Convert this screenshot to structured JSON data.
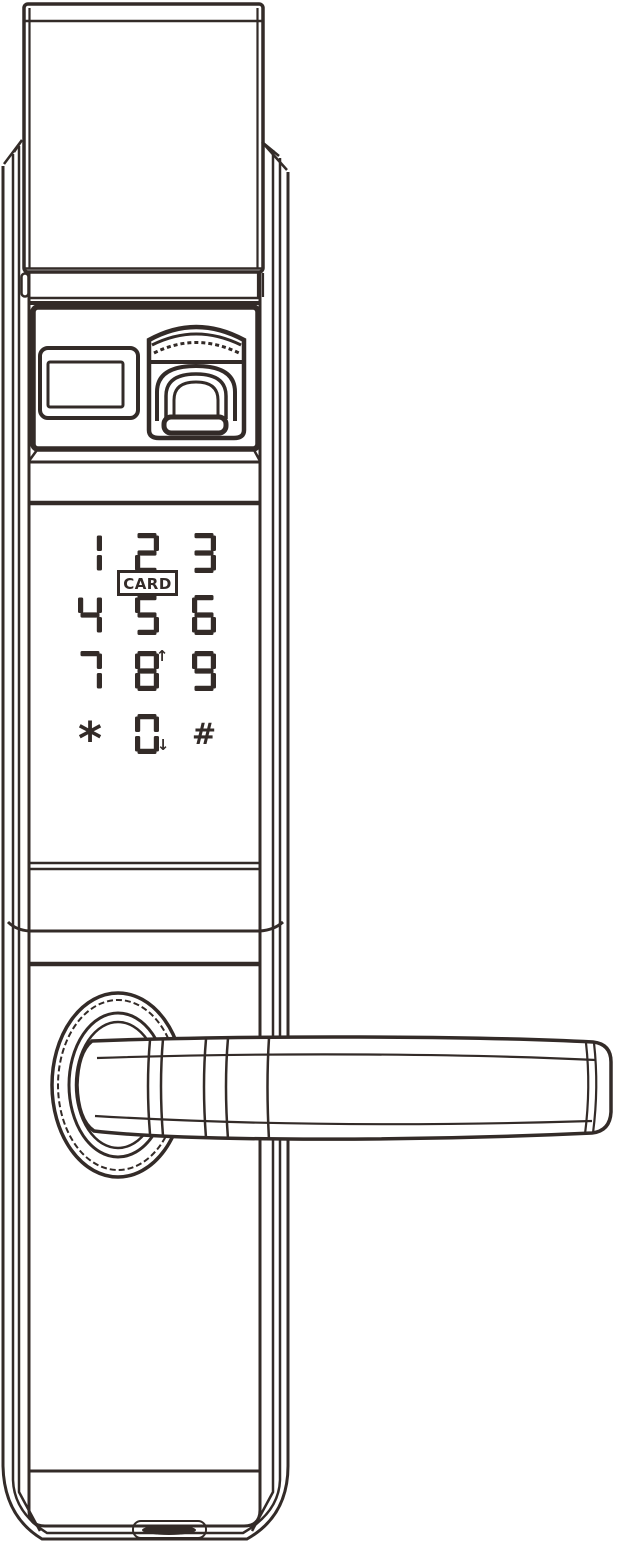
{
  "figure": {
    "kind": "technical line drawing",
    "subject": "smart door lock exterior unit, front view",
    "ink_color": "#332b28",
    "background_color": "#ffffff"
  },
  "keypad": {
    "rows": [
      [
        "1",
        "2",
        "3"
      ],
      [
        "4",
        "5",
        "6"
      ],
      [
        "7",
        "8",
        "9"
      ],
      [
        "*",
        "0",
        "#"
      ]
    ],
    "card_label": "CARD",
    "key_8_arrow": "↑",
    "key_0_arrow": "↓"
  }
}
